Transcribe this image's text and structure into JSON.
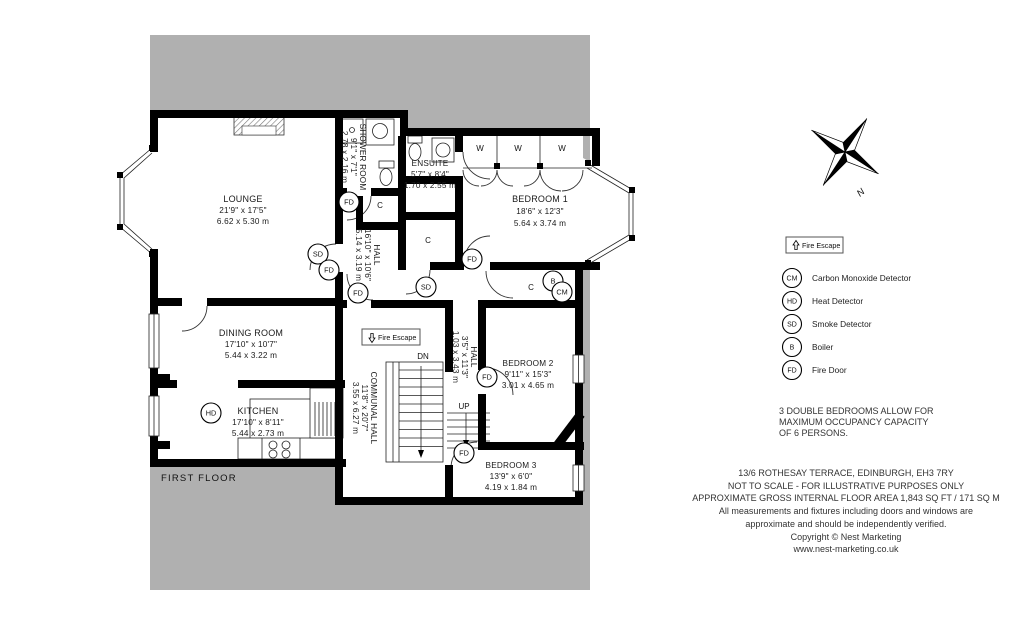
{
  "floor_label": "FIRST FLOOR",
  "rooms": {
    "lounge": {
      "name": "LOUNGE",
      "imperial": "21'9\" x 17'5\"",
      "metric": "6.62 x 5.30 m"
    },
    "shower_room": {
      "name": "SHOWER ROOM",
      "imperial": "9'1\" x 7'1\"",
      "metric": "2.78 x 2.16 m"
    },
    "ensuite": {
      "name": "ENSUITE",
      "imperial": "5'7\" x 8'4\"",
      "metric": "1.70 x 2.55 m"
    },
    "bedroom1": {
      "name": "BEDROOM 1",
      "imperial": "18'6\" x 12'3\"",
      "metric": "5.64 x 3.74 m"
    },
    "hall": {
      "name": "HALL",
      "imperial": "16'10\" x 10'6\"",
      "metric": "5.14 x 3.19 m"
    },
    "dining_room": {
      "name": "DINING ROOM",
      "imperial": "17'10\" x 10'7\"",
      "metric": "5.44 x 3.22 m"
    },
    "kitchen": {
      "name": "KITCHEN",
      "imperial": "17'10\" x 8'11\"",
      "metric": "5.44 x 2.73 m"
    },
    "communal_hall": {
      "name": "COMMUNAL HALL",
      "imperial": "11'8\" x 20'7\"",
      "metric": "3.55 x 6.27 m"
    },
    "inner_hall": {
      "name": "HALL",
      "imperial": "3'5\" x 11'3\"",
      "metric": "1.03 x 3.43 m"
    },
    "bedroom2": {
      "name": "BEDROOM 2",
      "imperial": "9'11\" x 15'3\"",
      "metric": "3.01 x 4.65 m"
    },
    "bedroom3": {
      "name": "BEDROOM 3",
      "imperial": "13'9\" x 6'0\"",
      "metric": "4.19 x 1.84 m"
    }
  },
  "markers": {
    "fire_door": "FD",
    "smoke_detector": "SD",
    "heat_detector": "HD",
    "carbon_monoxide": "CM",
    "boiler": "B",
    "cupboard": "C",
    "wardrobe": "W",
    "stairs_down": "DN",
    "stairs_up": "UP"
  },
  "fire_escape": {
    "plan_label": "Fire Escape",
    "legend_label": "Fire Escape"
  },
  "compass": {
    "north": "N"
  },
  "legend": {
    "items": [
      {
        "symbol": "CM",
        "label": "Carbon Monoxide Detector"
      },
      {
        "symbol": "HD",
        "label": "Heat Detector"
      },
      {
        "symbol": "SD",
        "label": "Smoke Detector"
      },
      {
        "symbol": "B",
        "label": "Boiler"
      },
      {
        "symbol": "FD",
        "label": "Fire Door"
      }
    ]
  },
  "notes": {
    "occupancy_line1": "3 DOUBLE BEDROOMS ALLOW FOR",
    "occupancy_line2": "MAXIMUM OCCUPANCY CAPACITY",
    "occupancy_line3": "OF 6 PERSONS.",
    "address": "13/6 ROTHESAY TERRACE, EDINBURGH, EH3 7RY",
    "scale": "NOT TO SCALE - FOR ILLUSTRATIVE PURPOSES ONLY",
    "area": "APPROXIMATE GROSS INTERNAL FLOOR AREA 1,843 SQ FT / 171 SQ M",
    "disclaimer_line1": "All measurements and fixtures including doors and windows are",
    "disclaimer_line2": "approximate and should be independently verified.",
    "copyright": "Copyright © Nest Marketing",
    "website": "www.nest-marketing.co.uk"
  },
  "colors": {
    "mask_gray": "#b0b0b0",
    "wall": "#000000",
    "line": "#222222",
    "text": "#1a1a1a",
    "note_text": "#333333"
  }
}
